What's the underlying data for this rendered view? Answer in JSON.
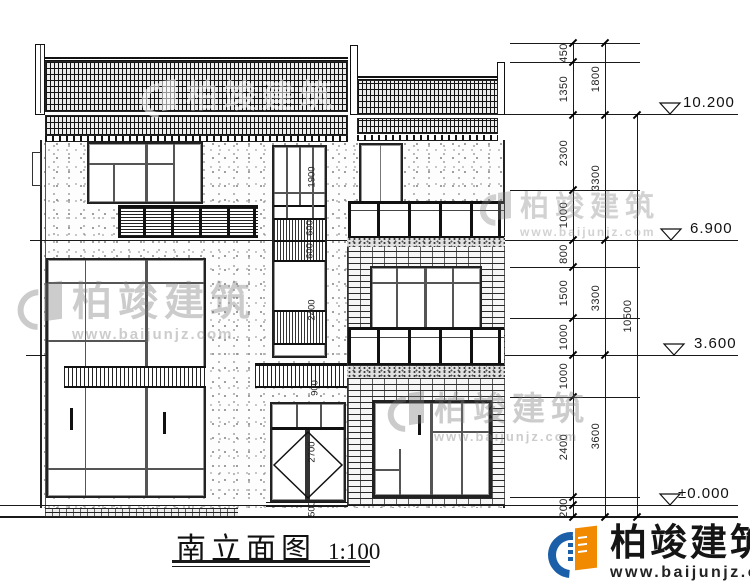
{
  "title": {
    "text": "南立面图",
    "scale": "1:100"
  },
  "watermark": {
    "brand": "柏竣建筑",
    "url": "www.baijunjz.com"
  },
  "logo": {
    "brand": "柏竣建筑",
    "url": "www.baijunjz.com",
    "blue": "#1b5fa9",
    "orange": "#f18a00"
  },
  "levels": [
    "10.200",
    "6.900",
    "3.600",
    "±0.000"
  ],
  "dims": {
    "chain1": [
      "450",
      "1350",
      "2300",
      "1000",
      "800",
      "1500",
      "1000",
      "1000",
      "2400",
      "200"
    ],
    "chain2": [
      "1800",
      "3300",
      "3300",
      "3600"
    ],
    "chain3": [
      "10500"
    ],
    "inner": [
      "1900",
      "600",
      "600",
      "2400",
      "900",
      "2700",
      "500"
    ]
  },
  "colors": {
    "line": "#1a1a1a",
    "logo_blue": "#1b5fa9",
    "logo_orange": "#f18a00"
  }
}
